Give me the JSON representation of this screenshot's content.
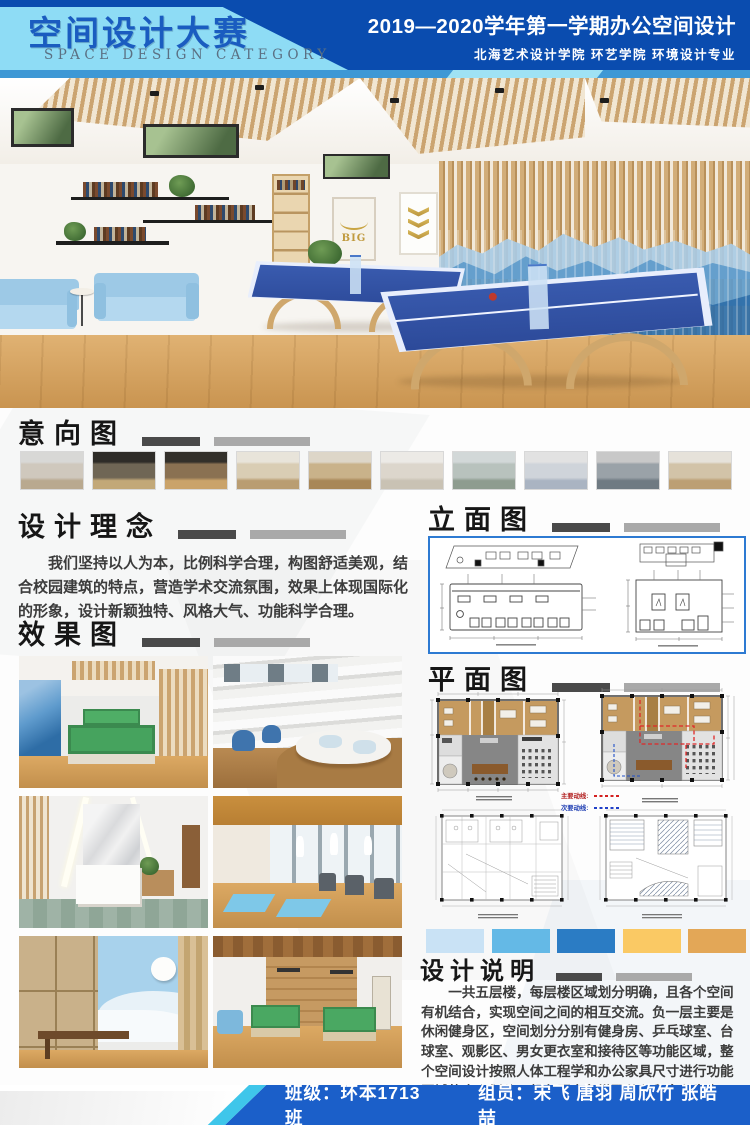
{
  "header": {
    "title_cn": "空间设计大赛",
    "title_en": "SPACE DESIGN CATEGORY",
    "course_line": "2019—2020学年第一学期办公空间设计",
    "school_line": "北海艺术设计学院  环艺学院  环境设计专业",
    "colors": {
      "navy": "#0a4caf",
      "light_blue": "#8edcf5",
      "strip_blue": "#3e98d5",
      "title_blue": "#1a5cc0"
    }
  },
  "hero": {
    "poster_big_text": "BIG"
  },
  "sections": {
    "intent": {
      "title": "意向图"
    },
    "concept": {
      "title": "设计理念",
      "body": "我们坚持以人为本，比例科学合理，构图舒适美观，结合校园建筑的特点，营造学术交流氛围，效果上体现国际化的形象，设计新颖独特、风格大气、功能科学合理。"
    },
    "renders": {
      "title": "效果图"
    },
    "elevation": {
      "title": "立面图"
    },
    "plan": {
      "title": "平面图"
    },
    "notes": {
      "title": "设计说明",
      "body": "一共五层楼，每层楼区域划分明确，且各个空间有机结合，实现空间之间的相互交流。负一层主要是休闲健身区，空间划分分别有健身房、乒乓球室、台球室、观影区、男女更衣室和接待区等功能区域，整个空间设计按照人体工程学和办公家具尺寸进行功能区域的大小划分。颜色原木色搭配蓝色和白色为主，其他辅助点缀色彩，简单大气。让人感受到舒心自在有一个良好的健身环境。"
    }
  },
  "plan_legend": {
    "primary": {
      "label": "主要动线:",
      "color": "#d42020"
    },
    "secondary": {
      "label": "次要动线:",
      "color": "#2040c8"
    }
  },
  "palette": {
    "colors": [
      "#c9e2f5",
      "#64b9e6",
      "#2b7cc4",
      "#fac964",
      "#e3a757"
    ]
  },
  "intent_thumbs": [
    [
      "#d8d8d6",
      "#cfc8bd",
      "#b9a98f"
    ],
    [
      "#2e2c28",
      "#6f6655",
      "#c2a878"
    ],
    [
      "#33302a",
      "#8a7152",
      "#caa36a"
    ],
    [
      "#e8e4da",
      "#d9cdb4",
      "#b99d72"
    ],
    [
      "#ddd6c8",
      "#c9b28a",
      "#a88757"
    ],
    [
      "#eceae6",
      "#dcd6cc",
      "#c9c2b4"
    ],
    [
      "#d2d8d8",
      "#b8c2bd",
      "#8e9c8f"
    ],
    [
      "#e2e2e2",
      "#cfd4da",
      "#aab4c2"
    ],
    [
      "#c8c8c8",
      "#9aa2a8",
      "#6f7a82"
    ],
    [
      "#e6e2da",
      "#d2c3a8",
      "#bc9f74"
    ]
  ],
  "footer": {
    "class_label": "班级：环本1713班",
    "members_label": "组员：宋飞  唐羽  周欣竹  张皓喆"
  }
}
